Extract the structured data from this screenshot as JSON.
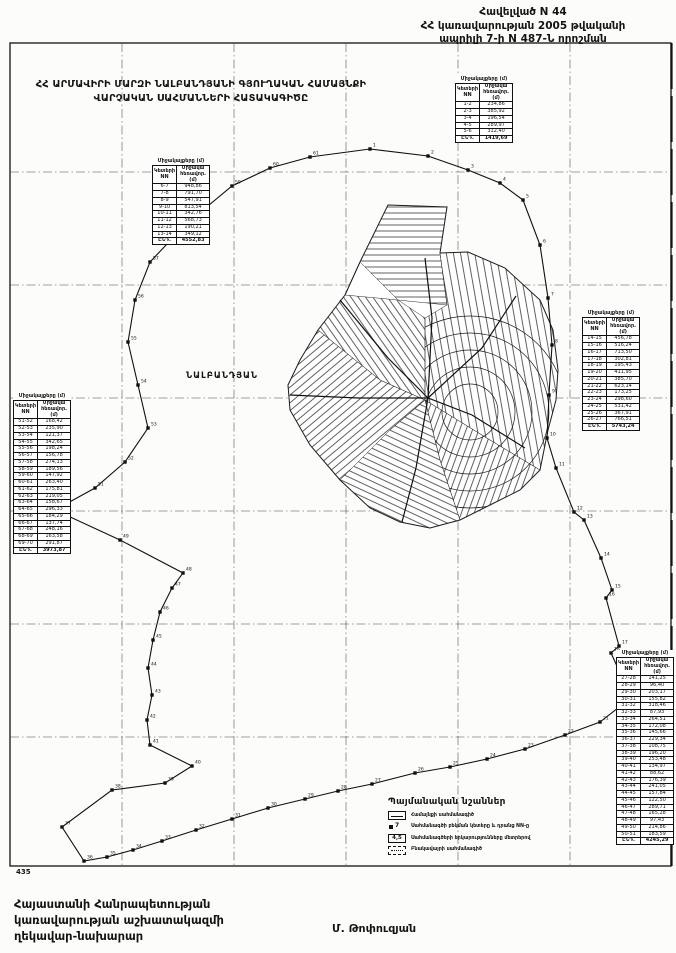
{
  "header": {
    "line1": "Հավելված N 44",
    "line2": "ՀՀ կառավարության 2005 թվականի",
    "line3": "ապրիլի 7-ի N 487-Ն որոշման"
  },
  "map": {
    "title_line1": "ՀՀ ԱՐՄԱՎԻՐԻ ՄԱՐԶԻ ՆԱԼԲԱՆԴՅԱՆԻ ԳՅՈՒՂԱԿԱՆ ՀԱՄԱՅՆՔԻ",
    "title_line2": "ՎԱՐՉԱԿԱՆ ՍԱՀՄԱՆՆԵՐԻ ՀԱՏԱԿԱԳԻԾԸ",
    "settlement_label": "ՆԱԼԲԱՆԴՅԱՆ",
    "corner_label": "435"
  },
  "tables": {
    "top_center": {
      "caption": "Միջակայքերը (մ)",
      "headers": [
        "Կետերի NN",
        "Միջակա հեռավոր. (մ)"
      ],
      "rows": [
        [
          "1-2",
          "234,86"
        ],
        [
          "2-3",
          "385,92"
        ],
        [
          "3-4",
          "196,54"
        ],
        [
          "4-5",
          "289,97"
        ],
        [
          "5-6",
          "312,40"
        ]
      ],
      "total": [
        "ԸՆԴ.",
        "1419,69"
      ]
    },
    "top_left": {
      "caption": "Միջակայքերը (մ)",
      "headers": [
        "Կետերի NN",
        "Միջակա հեռավոր. (մ)"
      ],
      "rows": [
        [
          "6-7",
          "948,86"
        ],
        [
          "7-8",
          "791,70"
        ],
        [
          "8-9",
          "547,91"
        ],
        [
          "9-10",
          "813,54"
        ],
        [
          "10-11",
          "342,76"
        ],
        [
          "11-12",
          "568,73"
        ],
        [
          "12-13",
          "190,21"
        ],
        [
          "13-14",
          "349,12"
        ]
      ],
      "total": [
        "ԸՆԴ.",
        "4552,83"
      ]
    },
    "right": {
      "caption": "Միջակայքերը (մ)",
      "headers": [
        "Կետերի NN",
        "Միջակա հեռավոր. (մ)"
      ],
      "rows": [
        [
          "14-15",
          "456,78"
        ],
        [
          "15-16",
          "516,24"
        ],
        [
          "16-17",
          "713,50"
        ],
        [
          "17-18",
          "302,81"
        ],
        [
          "18-19",
          "195,43"
        ],
        [
          "19-20",
          "411,95"
        ],
        [
          "20-21",
          "385,70"
        ],
        [
          "21-22",
          "623,14"
        ],
        [
          "22-23",
          "173,25"
        ],
        [
          "23-24",
          "298,60"
        ],
        [
          "24-25",
          "531,42"
        ],
        [
          "25-26",
          "367,91"
        ],
        [
          "26-27",
          "766,51"
        ]
      ],
      "total": [
        "ԸՆԴ.",
        "5743,24"
      ]
    },
    "bottom_right": {
      "caption": "Միջակայքերը (մ)",
      "headers": [
        "Կետերի NN",
        "Միջակա հեռավոր. (մ)"
      ],
      "rows": [
        [
          "27-28",
          "141,25"
        ],
        [
          "28-29",
          "96,40"
        ],
        [
          "29-30",
          "203,17"
        ],
        [
          "30-31",
          "155,82"
        ],
        [
          "31-32",
          "318,46"
        ],
        [
          "32-33",
          "87,93"
        ],
        [
          "33-34",
          "264,51"
        ],
        [
          "34-35",
          "172,08"
        ],
        [
          "35-36",
          "145,66"
        ],
        [
          "36-37",
          "229,34"
        ],
        [
          "37-38",
          "108,75"
        ],
        [
          "38-39",
          "196,20"
        ],
        [
          "39-40",
          "253,48"
        ],
        [
          "40-41",
          "134,97"
        ],
        [
          "41-42",
          "88,62"
        ],
        [
          "42-43",
          "176,39"
        ],
        [
          "43-44",
          "241,05"
        ],
        [
          "44-45",
          "157,84"
        ],
        [
          "45-46",
          "122,50"
        ],
        [
          "46-47",
          "289,71"
        ],
        [
          "47-48",
          "165,28"
        ],
        [
          "48-49",
          "97,43"
        ],
        [
          "49-50",
          "214,86"
        ],
        [
          "50-51",
          "183,59"
        ]
      ],
      "total": [
        "ԸՆԴ.",
        "4245,29"
      ]
    },
    "left": {
      "caption": "Միջակայքերը (մ)",
      "headers": [
        "Կետերի NN",
        "Միջակա հեռավոր. (մ)"
      ],
      "rows": [
        [
          "51-52",
          "168,42"
        ],
        [
          "52-53",
          "235,90"
        ],
        [
          "53-54",
          "121,37"
        ],
        [
          "54-55",
          "342,65"
        ],
        [
          "55-56",
          "198,24"
        ],
        [
          "56-57",
          "156,78"
        ],
        [
          "57-58",
          "274,13"
        ],
        [
          "58-59",
          "189,56"
        ],
        [
          "59-60",
          "147,92"
        ],
        [
          "60-61",
          "263,40"
        ],
        [
          "61-62",
          "175,81"
        ],
        [
          "62-63",
          "219,05"
        ],
        [
          "63-64",
          "158,67"
        ],
        [
          "64-65",
          "296,33"
        ],
        [
          "65-66",
          "184,29"
        ],
        [
          "66-67",
          "137,74"
        ],
        [
          "67-68",
          "248,16"
        ],
        [
          "68-69",
          "163,58"
        ],
        [
          "69-70",
          "291,87"
        ]
      ],
      "total": [
        "ԸՆԴ.",
        "3973,87"
      ]
    }
  },
  "legend": {
    "title": "Պայմանական նշաններ",
    "items": [
      {
        "symbol": "boundary-line",
        "label": "Համայնքի սահմանագիծ"
      },
      {
        "symbol": "boundary-point",
        "symbol_text": "7",
        "label": "Սահմանագծի բեկման կետերը և դրանց NN-ը"
      },
      {
        "symbol": "distance-value",
        "symbol_text": "4,5",
        "label": "Սահմանագծերի երկարությունները մետրերով"
      },
      {
        "symbol": "settlement-line",
        "label": "Բնակավայրի սահմանագիծ"
      }
    ]
  },
  "footer": {
    "line1": "Հայաստանի Հանրապետության",
    "line2": "կառավարության աշխատակազմի",
    "line3": "ղեկավար-նախարար",
    "signature": "Մ. Թոփուզյան"
  },
  "colors": {
    "ink": "#141414",
    "paper": "#fcfcfa"
  }
}
